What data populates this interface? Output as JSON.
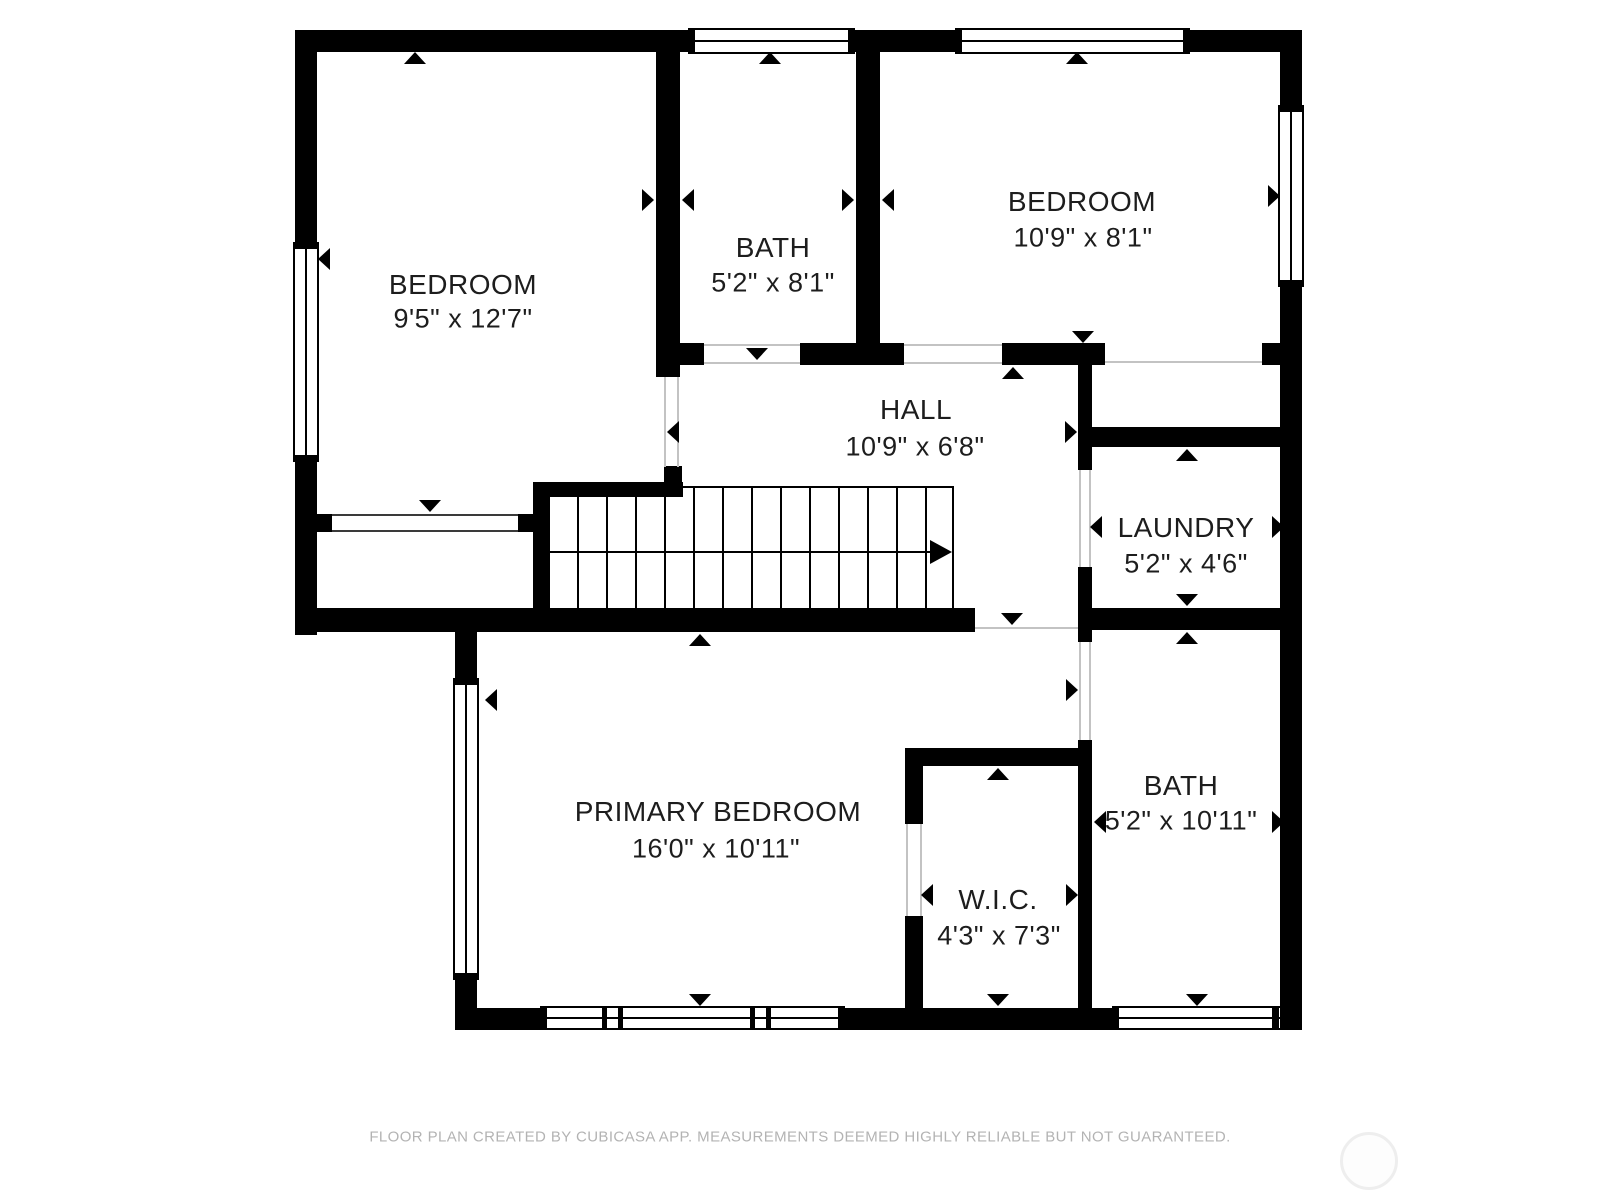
{
  "floorplan": {
    "rooms": [
      {
        "name": "BEDROOM",
        "dims": "9'5\" x 12'7\""
      },
      {
        "name": "BATH",
        "dims": "5'2\" x 8'1\""
      },
      {
        "name": "BEDROOM",
        "dims": "10'9\" x 8'1\""
      },
      {
        "name": "HALL",
        "dims": "10'9\" x 6'8\""
      },
      {
        "name": "LAUNDRY",
        "dims": "5'2\" x 4'6\""
      },
      {
        "name": "PRIMARY BEDROOM",
        "dims": "16'0\" x 10'11\""
      },
      {
        "name": "W.I.C.",
        "dims": "4'3\" x 7'3\""
      },
      {
        "name": "BATH",
        "dims": "5'2\" x 10'11\""
      }
    ],
    "footer": "FLOOR PLAN CREATED BY CUBICASA APP. MEASUREMENTS DEEMED HIGHLY RELIABLE BUT NOT GUARANTEED.",
    "colors": {
      "wall": "#000000",
      "text": "#1d1d1d",
      "footer_text": "#b3b3b3",
      "opening_line": "#c3c3c3",
      "background": "#ffffff"
    }
  }
}
